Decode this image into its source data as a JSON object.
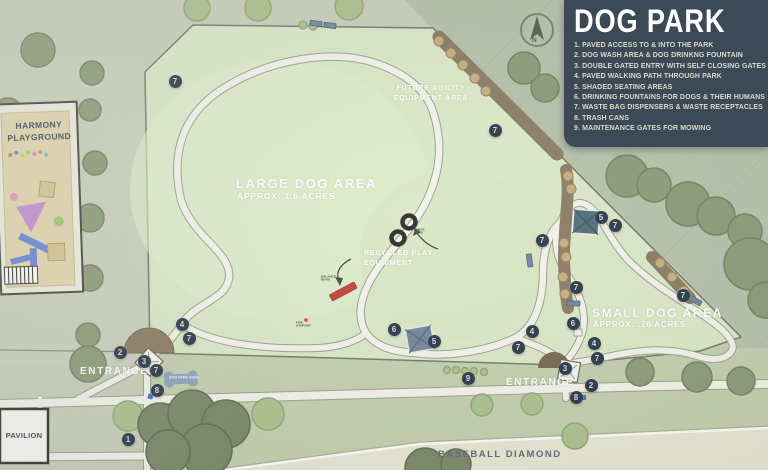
{
  "legend": {
    "title": "DOG PARK",
    "items": [
      "1. PAVED ACCESS TO & INTO THE PARK",
      "2. DOG WASH AREA & DOG DRINKNG FOUNTAIN",
      "3. DOUBLE GATED ENTRY WITH SELF CLOSING GATES",
      "4. PAVED WALKING PATH THROUGH PARK",
      "5. SHADED SEATING AREAS",
      "6. DRINKING FOUNTAINS FOR DOGS & THEIR HUMANS",
      "7. WASTE BAG DISPENSERS & WASTE RECEPTACLES",
      "8. TRASH CANS",
      "9. MAINTENANCE GATES FOR MOWING"
    ]
  },
  "areas": {
    "large_dog_title": "LARGE DOG AREA",
    "large_dog_sub": "APPROX: 1.6 ACRES",
    "small_dog_title": "SMALL DOG AREA",
    "small_dog_sub": "APPROX: .26 ACRES",
    "future_agility": "FUTURE AGILITY\nEQUIPMENT AREA",
    "recycled_play": "RECYCLED PLAY\nEQUIPMENT"
  },
  "labels": {
    "harmony_playground": "HARMONY\nPLAYGROUND",
    "entrance_west": "ENTRANCE",
    "entrance_south": "ENTRANCE",
    "pavilion": "PAVILION",
    "baseball_diamond": "BASEBALL DIAMOND",
    "dog_park_sign": "DOG PARK SIGN",
    "large_tires": "LARGE\nTIRES",
    "fire_hydrant": "FIRE\nHYDRANT",
    "balance_beam": "BALANCE\nBEAM",
    "compass_north": "N"
  },
  "markers": [
    {
      "label": "7",
      "x": 175,
      "y": 81
    },
    {
      "label": "7",
      "x": 495,
      "y": 130
    },
    {
      "label": "5",
      "x": 601,
      "y": 217
    },
    {
      "label": "7",
      "x": 615,
      "y": 225
    },
    {
      "label": "7",
      "x": 542,
      "y": 240
    },
    {
      "label": "7",
      "x": 576,
      "y": 287
    },
    {
      "label": "7",
      "x": 683,
      "y": 295
    },
    {
      "label": "6",
      "x": 573,
      "y": 323
    },
    {
      "label": "4",
      "x": 594,
      "y": 343
    },
    {
      "label": "7",
      "x": 597,
      "y": 358
    },
    {
      "label": "3",
      "x": 565,
      "y": 368
    },
    {
      "label": "2",
      "x": 591,
      "y": 385
    },
    {
      "label": "8",
      "x": 576,
      "y": 397
    },
    {
      "label": "9",
      "x": 468,
      "y": 378
    },
    {
      "label": "4",
      "x": 532,
      "y": 331
    },
    {
      "label": "7",
      "x": 518,
      "y": 347
    },
    {
      "label": "6",
      "x": 394,
      "y": 329
    },
    {
      "label": "5",
      "x": 434,
      "y": 341
    },
    {
      "label": "4",
      "x": 182,
      "y": 324
    },
    {
      "label": "7",
      "x": 189,
      "y": 338
    },
    {
      "label": "2",
      "x": 120,
      "y": 352
    },
    {
      "label": "3",
      "x": 144,
      "y": 361
    },
    {
      "label": "7",
      "x": 156,
      "y": 370
    },
    {
      "label": "8",
      "x": 157,
      "y": 390
    },
    {
      "label": "1",
      "x": 128,
      "y": 439
    }
  ],
  "colors": {
    "legend_bg": "#3b4a56",
    "park_green": "#dce8c8",
    "outside_green": "#b8c2ac",
    "path": "#f3f3eb",
    "mulch": "#8d7d65",
    "marker": "#2d3c4b",
    "beam_red": "#c2473c"
  }
}
